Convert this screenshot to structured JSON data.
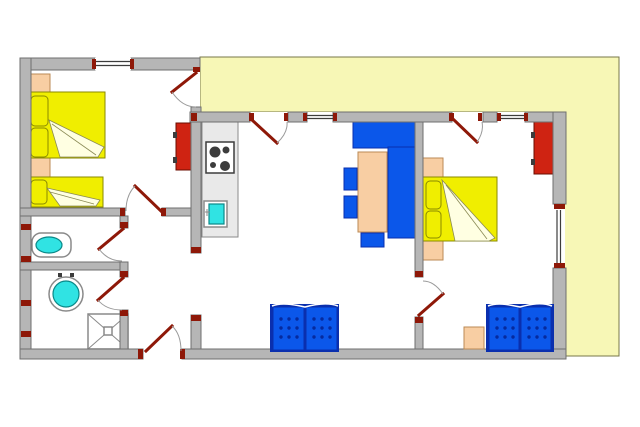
{
  "colors": {
    "floor": "#ffffff",
    "wall": "#b6b6b6",
    "wallEdge": "#6f6f6f",
    "terrace": "#f7f7b6",
    "terraceEdge": "#77774a",
    "doorRed": "#8e1808",
    "arcGray": "#9a9a9a",
    "lineDark": "#3c3c3c",
    "bedYellow": "#f0ee00",
    "bedEdge": "#8a8a00",
    "fold": "#ffffe2",
    "foldEdge": "#8a8a55",
    "peach": "#f8cea3",
    "peachEdge": "#bb8a55",
    "red": "#cf2312",
    "redEdge": "#6b0d00",
    "blue": "#0b57ea",
    "blueEdge": "#0a2fae",
    "blueDot": "#062a9e",
    "cyan": "#30e3e3",
    "cyanEdge": "#0b8888",
    "counter": "#e9e9e9",
    "counterEdge": "#8a8a8a",
    "fixture": "#8a8a8a"
  },
  "plan": {
    "rooms": [
      {
        "name": "bedroom-left",
        "furniture": [
          "double-bed",
          "single-bed",
          "nightstand",
          "nightstand",
          "wardrobe"
        ]
      },
      {
        "name": "wc",
        "furniture": [
          "toilet"
        ]
      },
      {
        "name": "bathroom",
        "furniture": [
          "washbasin",
          "shower"
        ]
      },
      {
        "name": "hallway",
        "furniture": []
      },
      {
        "name": "kitchen",
        "furniture": [
          "counter",
          "stove",
          "kitchen-sink"
        ]
      },
      {
        "name": "living-dining",
        "furniture": [
          "corner-cabinet",
          "dining-table",
          "chair",
          "chair",
          "chair",
          "sofa"
        ]
      },
      {
        "name": "bedroom-right",
        "furniture": [
          "double-bed",
          "headboard-shelf",
          "wardrobe",
          "sofa",
          "side-table"
        ]
      },
      {
        "name": "terrace",
        "furniture": []
      }
    ],
    "doors": [
      "entrance-door",
      "bedroom-left-door",
      "wc-door",
      "bathroom-door",
      "bedroom-left-terrace-door",
      "kitchen-terrace-door",
      "bedroom-right-terrace-door",
      "bedroom-right-door"
    ],
    "window_count": 4
  }
}
